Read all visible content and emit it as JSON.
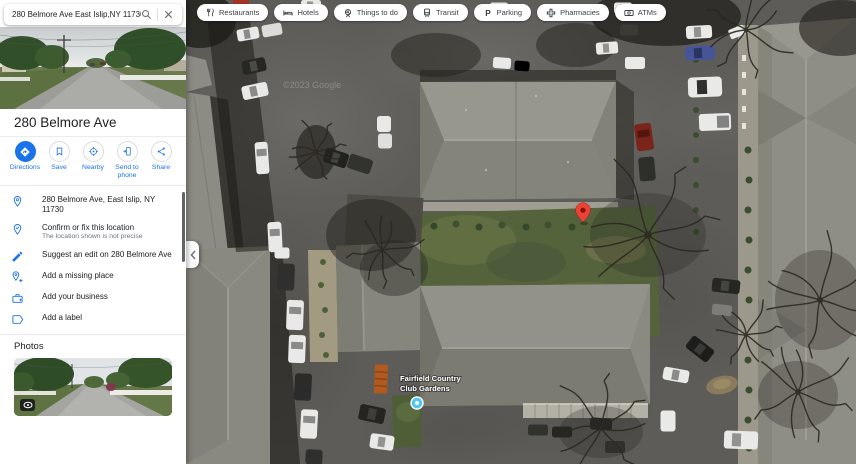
{
  "search": {
    "query": "280 Belmore Ave East Islip,NY 11730"
  },
  "chips": [
    {
      "label": "Restaurants"
    },
    {
      "label": "Hotels"
    },
    {
      "label": "Things to do"
    },
    {
      "label": "Transit"
    },
    {
      "label": "Parking"
    },
    {
      "label": "Pharmacies"
    },
    {
      "label": "ATMs"
    }
  ],
  "place": {
    "title": "280 Belmore Ave",
    "actions": [
      {
        "label": "Directions"
      },
      {
        "label": "Save"
      },
      {
        "label": "Nearby"
      },
      {
        "label": "Send to phone"
      },
      {
        "label": "Share"
      }
    ],
    "details": [
      {
        "label": "280 Belmore Ave, East Islip, NY 11730"
      },
      {
        "label": "Confirm or fix this location",
        "sublabel": "The location shown is not precise"
      },
      {
        "label": "Suggest an edit on 280 Belmore Ave"
      },
      {
        "label": "Add a missing place"
      },
      {
        "label": "Add your business"
      },
      {
        "label": "Add a label"
      }
    ],
    "photos_heading": "Photos"
  },
  "map": {
    "poi_label": "Fairfield Country Club Gardens",
    "poi_label_lines": [
      "Fairfield Country",
      "Club Gardens"
    ],
    "watermark": "©2023 Google",
    "marker_color": "#E94335",
    "poi_icon_color": "#4FC6F5"
  },
  "colors": {
    "accent_blue": "#1a73e8"
  }
}
